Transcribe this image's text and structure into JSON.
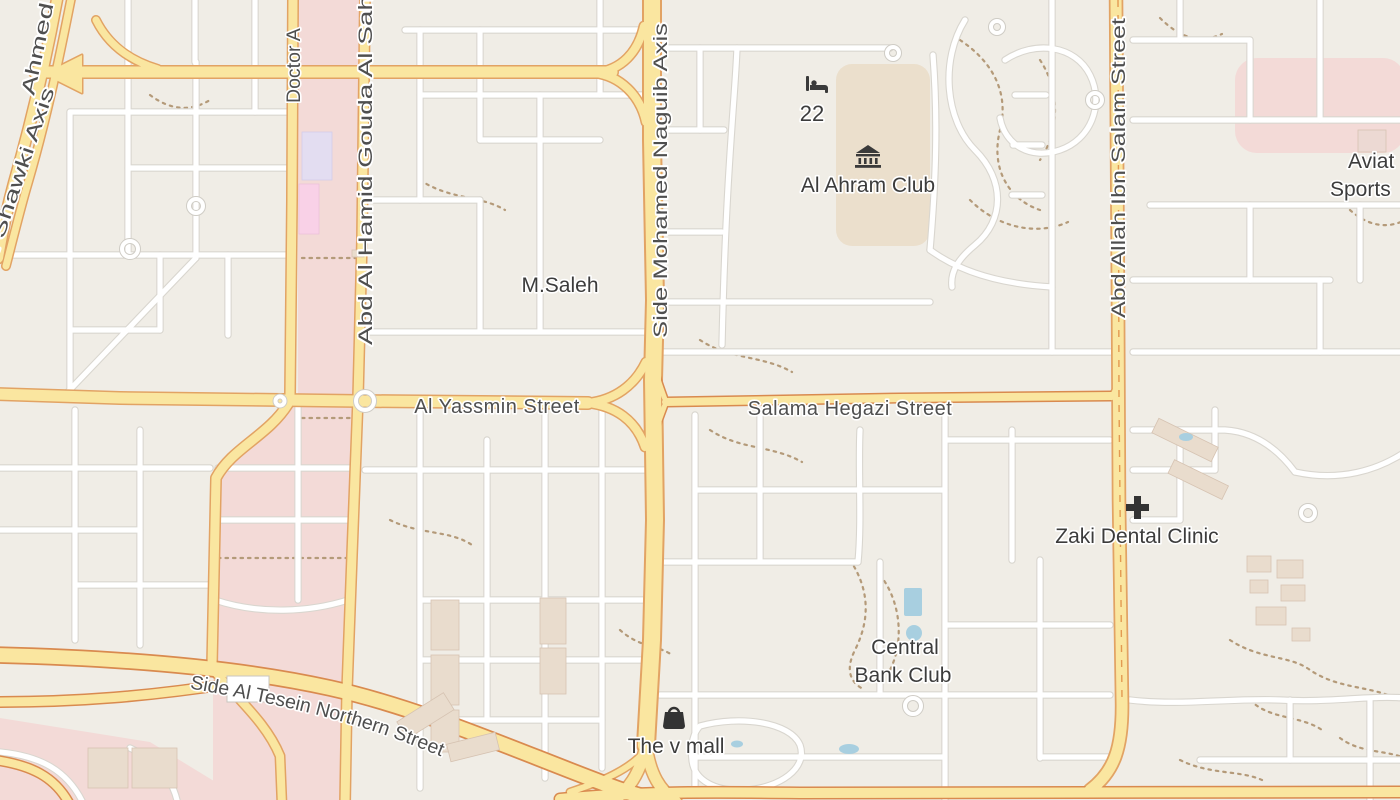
{
  "map": {
    "streets": {
      "ahmed_shawki_axis": "Ahmed Shawki Axis",
      "doctor_a": "Doctor A",
      "abd_al_hamid_gouda": "Abd Al Hamid Gouda Al Sah",
      "side_mohamed_naguib": "Side Mohamed Naguib Axis",
      "abd_allah_ibn_salam": "Abd Allah Ibn Salam Street",
      "al_yassmin": "Al Yassmin Street",
      "salama_hegazi": "Salama Hegazi Street",
      "side_al_tesein": "Side Al Tesein Northern Street"
    },
    "places": {
      "m_saleh": "M.Saleh",
      "al_ahram_club": "Al Ahram Club",
      "hotel_22": "22",
      "aviation_line1": "Aviat",
      "aviation_line2": "Sports",
      "zaki_dental_clinic": "Zaki Dental Clinic",
      "central_bank_line1": "Central",
      "central_bank_line2": "Bank Club",
      "the_v_mall": "The v mall"
    },
    "icons": {
      "hotel": "bed-icon",
      "museum": "museum-icon",
      "clinic": "cross-icon",
      "mall": "shopping-bag-icon"
    },
    "colors": {
      "land": "#f0ede6",
      "pink_zone": "#f3dad7",
      "club_grounds": "#ebdfcc",
      "street_fill": "#ffffff",
      "street_casing": "#d9d6cf",
      "road_fill": "#fae6a0",
      "road_casing": "#e2a364",
      "primary_casing": "#d98a4f",
      "path_dots": "#b49a79",
      "water": "#a8cfe0",
      "building_lavender": "#e3ddf1",
      "building_pink": "#f9d1e7",
      "building_tan": "#e9dccd",
      "label_text": "#4f4f4f",
      "poi_text": "#3c3c3c"
    }
  }
}
